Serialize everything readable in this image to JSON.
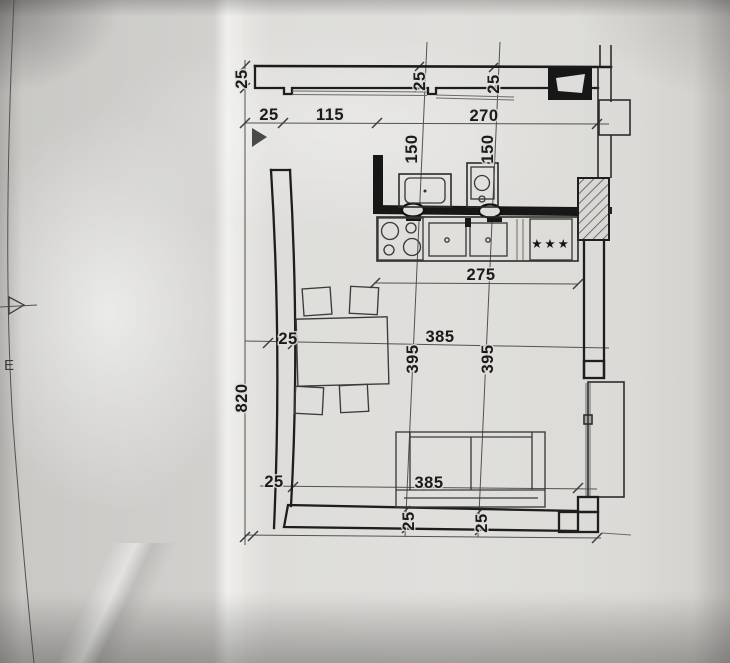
{
  "drawing": {
    "axis_label": "E",
    "freezer_stars": "★★★",
    "colors": {
      "ink": "#1e1e1e",
      "dim_line": "#525250",
      "paper": "#dedddb",
      "hatch_fill": "#d8d7d4"
    },
    "dims": {
      "wall_top_left_25": "25",
      "top_25": "25",
      "top_115": "115",
      "top_270": "270",
      "wall_top_mid_25": "25",
      "wall_top_right_25": "25",
      "kitchen_left_150": "150",
      "kitchen_right_150": "150",
      "counter_275": "275",
      "mid_left_25": "25",
      "mid_385": "385",
      "mid_left_395": "395",
      "mid_right_395": "395",
      "left_820": "820",
      "bottom_left_25": "25",
      "sofa_385": "385",
      "wall_bottom_left_25": "25",
      "wall_bottom_right_25": "25"
    }
  }
}
